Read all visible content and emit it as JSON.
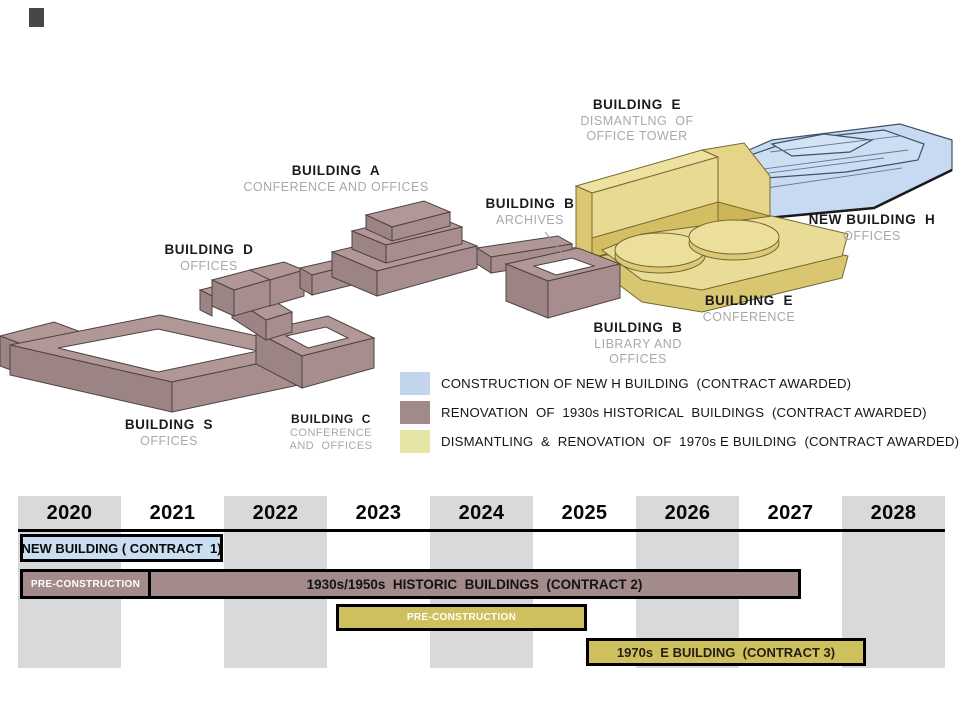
{
  "diagram": {
    "labels": {
      "e_top": {
        "name": "BUILDING  E",
        "sub": "DISMANTLNG  OF\nOFFICE TOWER"
      },
      "a": {
        "name": "BUILDING  A",
        "sub": "CONFERENCE AND OFFICES"
      },
      "b_archives": {
        "name": "BUILDING  B",
        "sub": "ARCHIVES"
      },
      "h": {
        "name": "NEW BUILDING  H",
        "sub": "OFFICES"
      },
      "d": {
        "name": "BUILDING  D",
        "sub": "OFFICES"
      },
      "e_conf": {
        "name": "BUILDING  E",
        "sub": "CONFERENCE"
      },
      "b_library": {
        "name": "BUILDING  B",
        "sub": "LIBRARY AND\nOFFICES"
      },
      "s": {
        "name": "BUILDING  S",
        "sub": "OFFICES"
      },
      "c": {
        "name": "BUILDING  C",
        "sub": "CONFERENCE\nAND  OFFICES"
      }
    },
    "building_colors": {
      "new_h_blue": "#c8daf1",
      "historic_mauve": "#ab9090",
      "e_building_yellow": "#e8da92"
    }
  },
  "legend": {
    "items": [
      {
        "color": "#c3d5ec",
        "label": "CONSTRUCTION OF NEW H BUILDING  (CONTRACT AWARDED)"
      },
      {
        "color": "#a18a8a",
        "label": "RENOVATION  OF  1930s HISTORICAL  BUILDINGS  (CONTRACT AWARDED)"
      },
      {
        "color": "#e7e5a5",
        "label": "DISMANTLING  &  RENOVATION  OF  1970s E BUILDING  (CONTRACT AWARDED)"
      }
    ]
  },
  "timeline": {
    "years": [
      "2020",
      "2021",
      "2022",
      "2023",
      "2024",
      "2025",
      "2026",
      "2027",
      "2028"
    ],
    "bars": {
      "contract1": "NEW BUILDING ( CONTRACT  1)",
      "pre_construction_2": "PRE-CONSTRUCTION",
      "contract2": "1930s/1950s  HISTORIC  BUILDINGS  (CONTRACT 2)",
      "pre_construction_3": "PRE-CONSTRUCTION",
      "contract3": "1970s  E BUILDING  (CONTRACT 3)"
    },
    "colors": {
      "contract1": "#cadef2",
      "contract2": "#a48b8b",
      "contract3": "#cfc05e",
      "band": "#d9d9d9"
    }
  },
  "chart_data": {
    "type": "table",
    "title": "Construction schedule (Gantt)",
    "axis_years": [
      2020,
      2028
    ],
    "bars": [
      {
        "label": "NEW BUILDING ( CONTRACT  1)",
        "start": 2020.0,
        "end": 2022.0,
        "color": "#cadef2"
      },
      {
        "label": "PRE-CONSTRUCTION",
        "start": 2020.0,
        "end": 2021.3,
        "color": "#a48b8b"
      },
      {
        "label": "1930s/1950s HISTORIC BUILDINGS (CONTRACT 2)",
        "start": 2021.3,
        "end": 2027.6,
        "color": "#a48b8b"
      },
      {
        "label": "PRE-CONSTRUCTION",
        "start": 2023.1,
        "end": 2025.5,
        "color": "#cfc05e"
      },
      {
        "label": "1970s E BUILDING (CONTRACT 3)",
        "start": 2025.5,
        "end": 2028.2,
        "color": "#cfc05e"
      }
    ]
  }
}
